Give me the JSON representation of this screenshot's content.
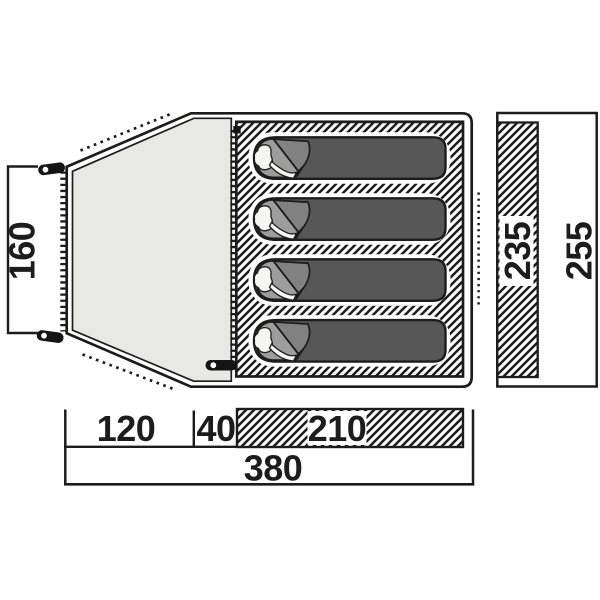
{
  "figure": {
    "type": "tent floor plan diagram with dimensions",
    "sleeping_bags": 4,
    "dimension_labels": {
      "porch_height": "160",
      "inner_depth": "235",
      "outer_depth": "255",
      "porch_length": "120",
      "front_gap": "40",
      "inner_length": "210",
      "total_length": "380"
    },
    "colors": {
      "outline": "#1c1c1c",
      "porch_fill": "#e8e8e6",
      "bag_fill": "#575757",
      "hood_fill": "#9d9d9d",
      "flap_fill": "#818181",
      "background": "#ffffff"
    }
  }
}
